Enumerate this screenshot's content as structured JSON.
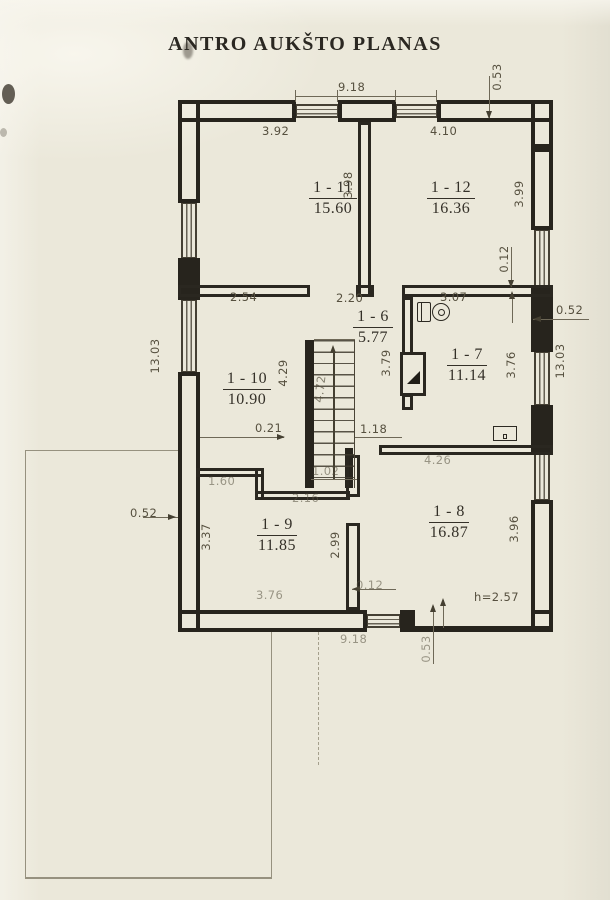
{
  "header": {
    "title": "ANTRO AUKŠTO PLANAS"
  },
  "rooms": {
    "r11": {
      "num": "1 - 11",
      "area": "15.60"
    },
    "r12": {
      "num": "1 - 12",
      "area": "16.36"
    },
    "r6": {
      "num": "1 - 6",
      "area": "5.77"
    },
    "r7": {
      "num": "1 - 7",
      "area": "11.14"
    },
    "r10": {
      "num": "1 - 10",
      "area": "10.90"
    },
    "r9": {
      "num": "1 - 9",
      "area": "11.85"
    },
    "r8": {
      "num": "1 - 8",
      "area": "16.87"
    }
  },
  "dims": {
    "top_total": "9.18",
    "top_right_offset": "0.53",
    "room11_width": "3.92",
    "room12_width": "4.10",
    "room11_depth": "3.98",
    "room12_depth": "3.99",
    "right_stub": "0.12",
    "seg_2_54": "2.54",
    "hall_width": "2.20",
    "room7_width": "3.07",
    "right_wall": "0.52",
    "left_total": "13.03",
    "right_total": "13.03",
    "room10_depth": "4.29",
    "stair_run": "4.72",
    "hall_depth": "3.79",
    "room7_depth": "3.76",
    "seg_0_21": "0.21",
    "seg_1_18": "1.18",
    "stair_width": "1.02",
    "room8_width": "4.26",
    "seg_1_60": "1.60",
    "seg_2_16": "2.16",
    "left_wall": "0.52",
    "room9_depth": "3.37",
    "seg_2_99": "2.99",
    "room8_depth": "3.96",
    "room9_width": "3.76",
    "bottom_stub": "0.12",
    "ceiling_height": "h=2.57",
    "bottom_total": "9.18",
    "bottom_offset": "0.53"
  },
  "icons": {
    "toilet": "wc-toilet",
    "stair_arrow": "stairs-up-arrow",
    "vent": "vent-triangle",
    "sink": "sink-fixture"
  },
  "colors": {
    "paper": "#ebe8da",
    "ink": "#27241d",
    "dim_text": "#56503f",
    "faint_line": "#96917f"
  }
}
